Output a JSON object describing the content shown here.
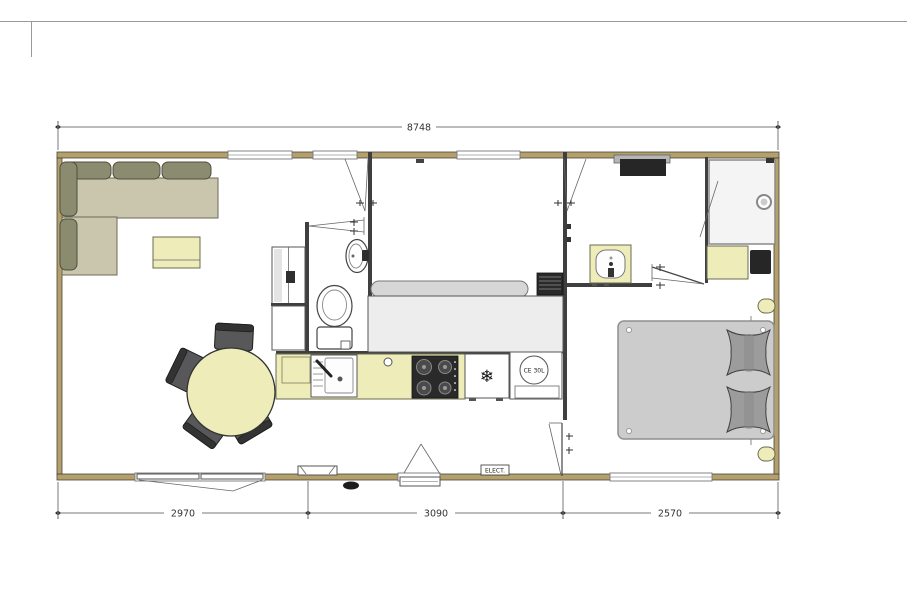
{
  "drawing": {
    "dimensions": {
      "overall_width_mm": "8748",
      "segment_left_mm": "2970",
      "segment_middle_mm": "3090",
      "segment_right_mm": "2570"
    },
    "labels": {
      "electrical_panel": "ELECT.",
      "water_heater": "CE 30L"
    },
    "icons": {
      "fridge_icon": "❄"
    },
    "colors": {
      "wall-fill": "#b3a06d",
      "wall-stroke": "#4a4435",
      "accent-yellow": "#eeedb9",
      "accent-yellow-stroke": "#6b6b50",
      "sofa-back": "#8b8b70",
      "sofa-seat": "#cac6ae",
      "chair-dark": "#58585a",
      "bed-gray": "#cccccc",
      "pillow-gray": "#9c9c9c",
      "mattress-light": "#ededed",
      "appliance-dark": "#2a2a2a",
      "dim-line": "#7a7a7a",
      "text-color": "#333333"
    }
  }
}
